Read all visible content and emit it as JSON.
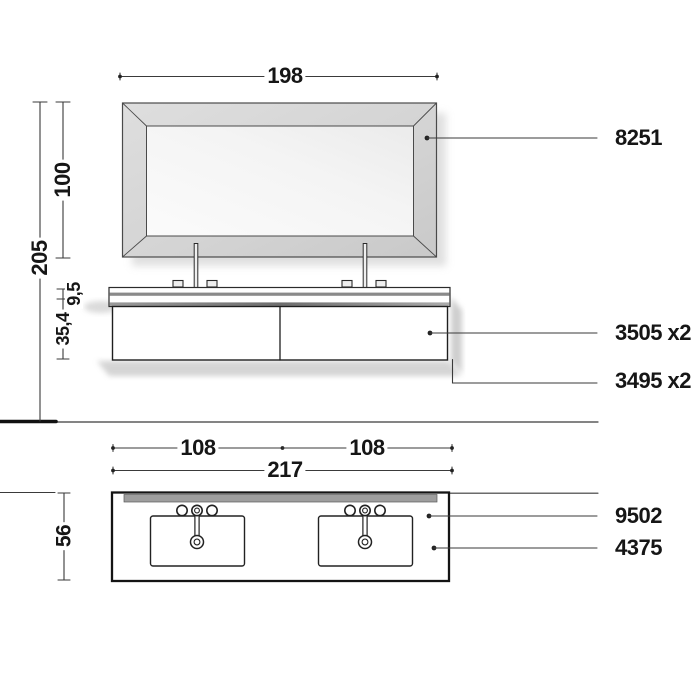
{
  "colors": {
    "background": "#ffffff",
    "line": "#2b2b2b",
    "dim_line": "#3a3a3a",
    "text": "#161616",
    "frame_fill": "#d6d6d6",
    "mirror_face": "#f3f3f3",
    "backsplash_gray": "#9e9e9e",
    "counter_strip_gray": "#8a8a8a",
    "shadow": "#bdbdbd"
  },
  "elevation": {
    "dim_width": "198",
    "dim_mirror_height": "100",
    "dim_total_height": "205",
    "dim_counter_thickness": "9,5",
    "dim_cabinet_height": "35,4",
    "callout_mirror": "8251",
    "callout_drawers": "3505 x2",
    "callout_structure": "3495 x2"
  },
  "plan": {
    "dim_sink_left": "108",
    "dim_sink_right": "108",
    "dim_total_width": "217",
    "dim_depth": "56",
    "callout_washbasin_top": "9502",
    "callout_basin": "4375"
  }
}
